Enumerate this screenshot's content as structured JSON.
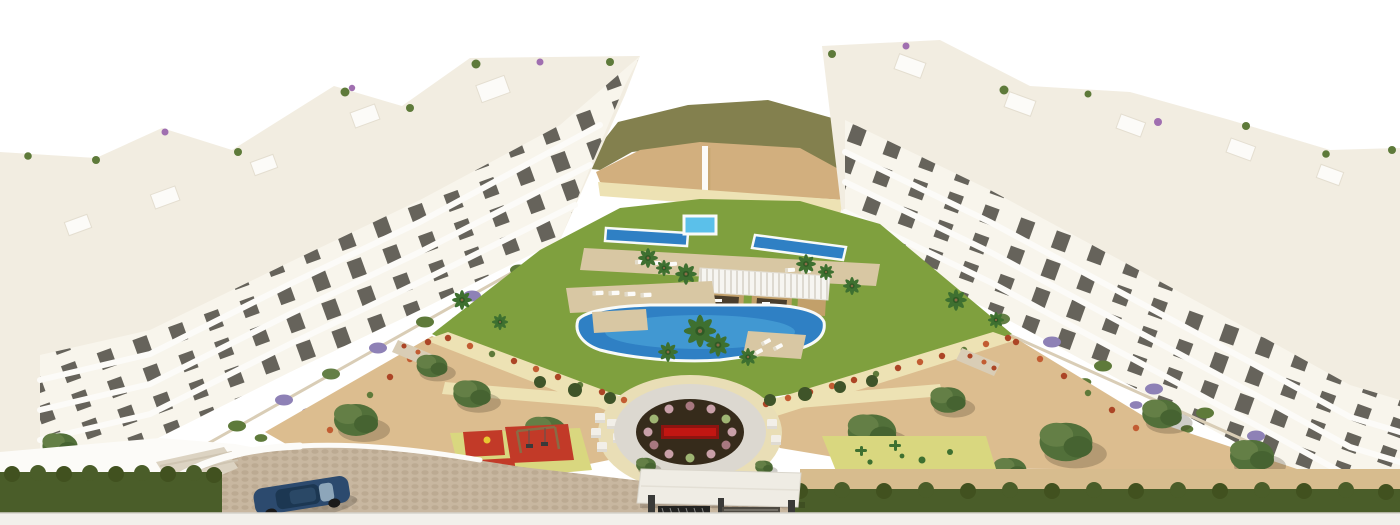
{
  "meta": {
    "type": "3d-architectural-render",
    "subject": "Aerial 3D render of a white modern apartment complex with a central landscaped courtyard, communal swimming pools, pergola cabanas, gardens, playgrounds, entrance gate and driveway with a blue car"
  },
  "image": {
    "width": 1400,
    "height": 525
  },
  "scene": {
    "buildings": {
      "left_cluster": "white stepped apartment blocks with balconies and roof terraces",
      "right_cluster": "white stepped apartment blocks with balconies and roof terraces"
    },
    "amenities": [
      "central lawn",
      "square plunge pool",
      "twin lap pools",
      "main swimming pool",
      "sun decks with loungers",
      "pergola cabanas",
      "circular flower plaza",
      "children playground",
      "cactus play garden",
      "entrance gate canopy",
      "cobblestone driveway",
      "blue car",
      "sand gardens with olive trees",
      "lavender terraces",
      "perimeter hedge",
      "sidewalk",
      "sand hill backdrop"
    ]
  },
  "colors": {
    "sky": "#FFFFFF",
    "oliveBand": "#83804E",
    "sandHill": "#D2AF7E",
    "sandHillShadow": "#C9A874",
    "sand": "#DCBD8F",
    "palePath": "#EDE2B4",
    "lawn": "#7FA03E",
    "lawnDark": "#6E8E35",
    "bushDark": "#3F5429",
    "facade": "#F8F5EC",
    "roofCream": "#F2EDE1",
    "white": "#FCFBF8",
    "shade": "#E2DBCA",
    "windowDark": "#45433B",
    "stone": "#D9CDB6",
    "lavender": "#8E81B6",
    "green": "#5E7A3A",
    "boug": "#A06FB0",
    "palmGreen": "#3E7030",
    "palmDark": "#2F5A25",
    "trunk": "#8A6B45",
    "oliveCanopy": "#52703A",
    "oliveLight": "#647F46",
    "oliveDark": "#466331",
    "redFlower": "#AC4526",
    "redFlower2": "#C25C32",
    "bushPink": "#C9A0A8",
    "bushRose": "#A87880",
    "bushSage": "#9FB573",
    "poolDeep": "#2F80C4",
    "poolMid": "#4FA8DC",
    "poolLight": "#5BC0EA",
    "rim": "#F8FAF8",
    "deckWood": "#D8C7A3",
    "pergRoof": "#F6F5F1",
    "pergSlat": "#DDD9D0",
    "pergWood": "#C2A06A",
    "pergDark": "#4A3E2C",
    "matYellow": "#D9D77F",
    "matRed": "#C23A28",
    "matRedDark": "#A93226",
    "plazaApron": "#E9DEB6",
    "plazaRing": "#DCD8D0",
    "plazaSoil": "#362B1B",
    "plazaRed": "#C21612",
    "plazaRedDark": "#8E1410",
    "cubeSeat": "#F2EFE8",
    "cubeShade": "#DFDBD2",
    "cobble": "#C8B7A0",
    "cobbleDot": "#BCAA92",
    "rampGray": "#DCD3C2",
    "sidewalk": "#F2F0EB",
    "sidewalkLine": "#D5D2CB",
    "hedge": "#4A5D29",
    "hedgeDark": "#41511F",
    "tanWall": "#D7BC8E",
    "carBody": "#2C4A6E",
    "carRoof": "#1C3752",
    "carGlass": "#9FB6C8",
    "wheel": "#1A1A1A",
    "swingWood": "#8A6B45",
    "swingSeat": "#3A3A3A",
    "springYellow": "#E8C832",
    "gateDark": "#232321",
    "gateGray": "#4E4A42",
    "canopy": "#EFECE4",
    "canopyEdge": "#DAD6CC"
  }
}
